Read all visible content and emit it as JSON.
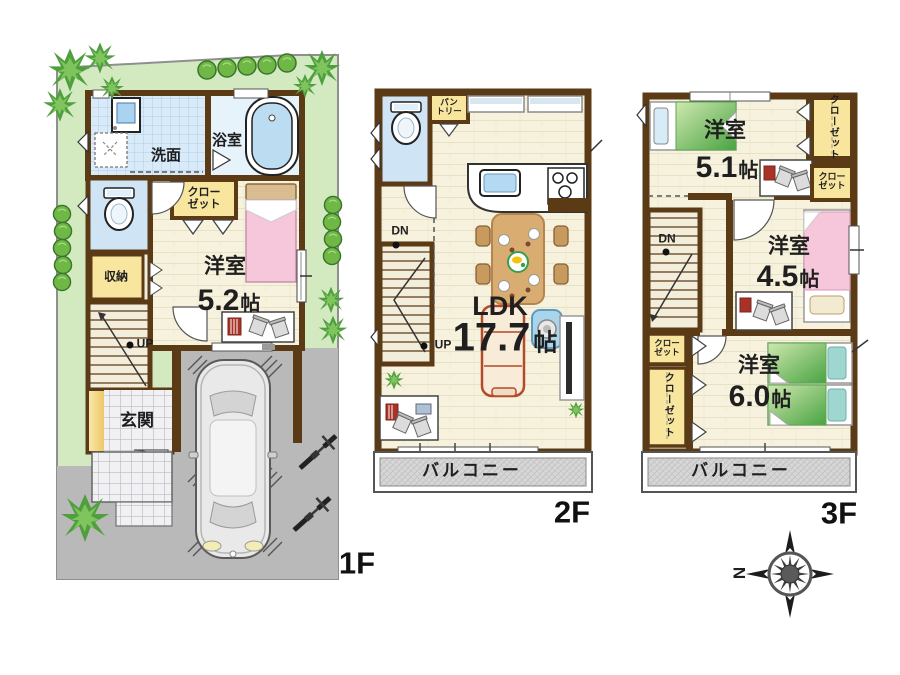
{
  "floors": {
    "f1": {
      "label": "1F",
      "washroom": "洗面",
      "bath": "浴室",
      "closet_line1": "クロー",
      "closet_line2": "ゼット",
      "storage": "収納",
      "room_name": "洋室",
      "room_size": "5.2",
      "unit": "帖",
      "up": "UP",
      "entrance": "玄関"
    },
    "f2": {
      "label": "2F",
      "pantry_line1": "パン",
      "pantry_line2": "トリー",
      "dn": "DN",
      "up": "UP",
      "ldk": "LDK",
      "ldk_size": "17.7",
      "unit": "帖",
      "balcony": "バルコニー"
    },
    "f3": {
      "label": "3F",
      "room1_name": "洋室",
      "room1_size": "5.1",
      "room2_name": "洋室",
      "room2_size": "4.5",
      "room3_name": "洋室",
      "room3_size": "6.0",
      "unit": "帖",
      "closet_top_vertical": "クローゼット",
      "closet_top2_line1": "クロー",
      "closet_top2_line2": "ゼット",
      "closet_left_line1": "クロー",
      "closet_left_line2": "ゼット",
      "closet_left_vertical": "クローゼット",
      "dn": "DN",
      "balcony": "バルコニー"
    }
  },
  "compass": {
    "north": "N"
  },
  "colors": {
    "wall": "#5b3a16",
    "yard": "#d3e9c0",
    "pavement": "#b9b9b9",
    "tile_floor": "#d9eaf8",
    "closet_yellow": "#f8e59e",
    "room_floor": "#f7f2de",
    "balcony_gray": "#d7d7d7",
    "bed_pink": "#f6c6da",
    "bed_green": "#49a341",
    "text": "#1f1f1f"
  }
}
